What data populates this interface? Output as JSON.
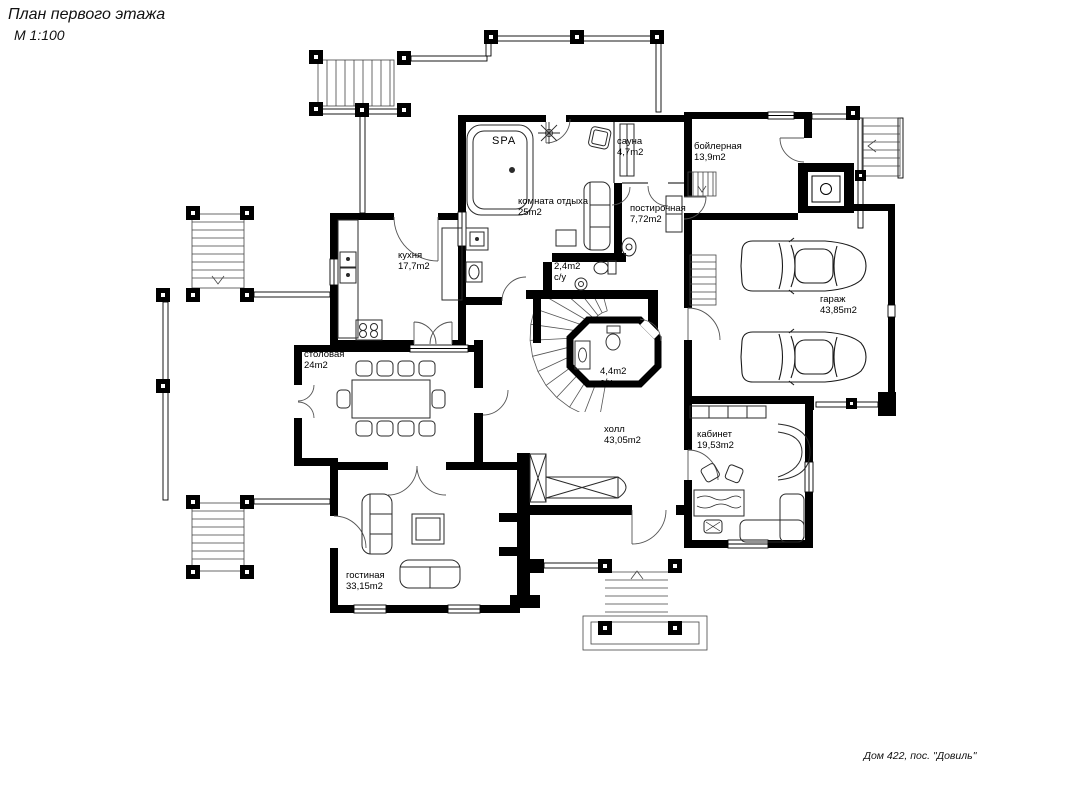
{
  "page": {
    "title_line1": "План первого этажа",
    "title_line2": "М 1:100",
    "footer": "Дом 422, пос. \"Довиль\""
  },
  "rooms": {
    "spa": {
      "name": "SPA",
      "area": ""
    },
    "sauna": {
      "name": "сауна",
      "area": "4,7m2"
    },
    "boiler": {
      "name": "бойлерная",
      "area": "13,9m2"
    },
    "lounge": {
      "name": "комната отдыха",
      "area": "25m2"
    },
    "laundry": {
      "name": "постирочная",
      "area": "7,72m2"
    },
    "kitchen": {
      "name": "кухня",
      "area": "17,7m2"
    },
    "wc_small": {
      "name": "2,4m2",
      "area": "с/у"
    },
    "garage": {
      "name": "гараж",
      "area": "43,85m2"
    },
    "dining": {
      "name": "столовая",
      "area": "24m2"
    },
    "wc_hall": {
      "name": "4,4m2",
      "area": "с/у"
    },
    "hall": {
      "name": "холл",
      "area": "43,05m2"
    },
    "office": {
      "name": "кабинет",
      "area": "19,53m2"
    },
    "living": {
      "name": "гостиная",
      "area": "33,15m2"
    }
  }
}
